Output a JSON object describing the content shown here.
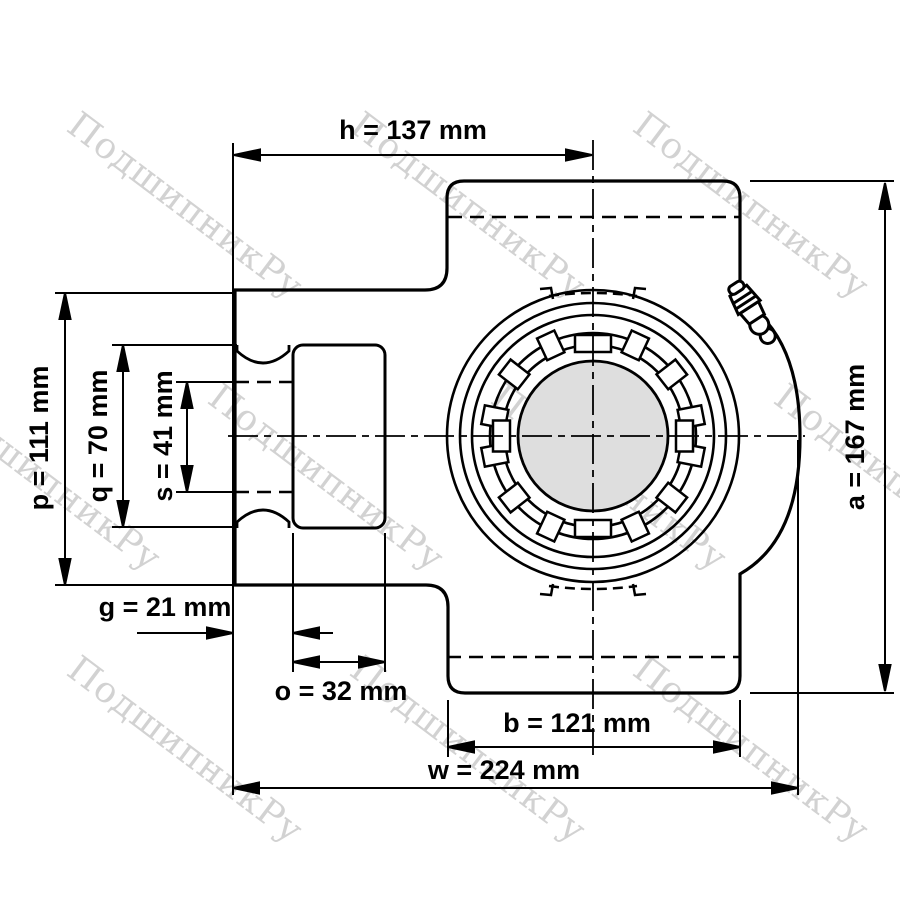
{
  "drawing": {
    "title": "Take-up bearing unit – dimensioned front view",
    "type": "technical-drawing",
    "units": "mm"
  },
  "watermark": {
    "text": "ПодшипникРу",
    "color": "#d2d2d2"
  },
  "dims": {
    "h": {
      "letter": "h",
      "value_mm": 137,
      "label": "h = 137 mm"
    },
    "a": {
      "letter": "a",
      "value_mm": 167,
      "label": "a = 167 mm"
    },
    "p": {
      "letter": "p",
      "value_mm": 111,
      "label": "p = 111 mm"
    },
    "q": {
      "letter": "q",
      "value_mm": 70,
      "label": "q = 70 mm"
    },
    "s": {
      "letter": "s",
      "value_mm": 41,
      "label": "s = 41 mm"
    },
    "g": {
      "letter": "g",
      "value_mm": 21,
      "label": "g = 21 mm"
    },
    "o": {
      "letter": "o",
      "value_mm": 32,
      "label": "o = 32 mm"
    },
    "b": {
      "letter": "b",
      "value_mm": 121,
      "label": "b = 121 mm"
    },
    "w": {
      "letter": "w",
      "value_mm": 224,
      "label": "w = 224 mm"
    }
  },
  "colors": {
    "line": "#000000",
    "bore_fill": "#dedede",
    "background": "#ffffff",
    "watermark": "#d2d2d2"
  }
}
